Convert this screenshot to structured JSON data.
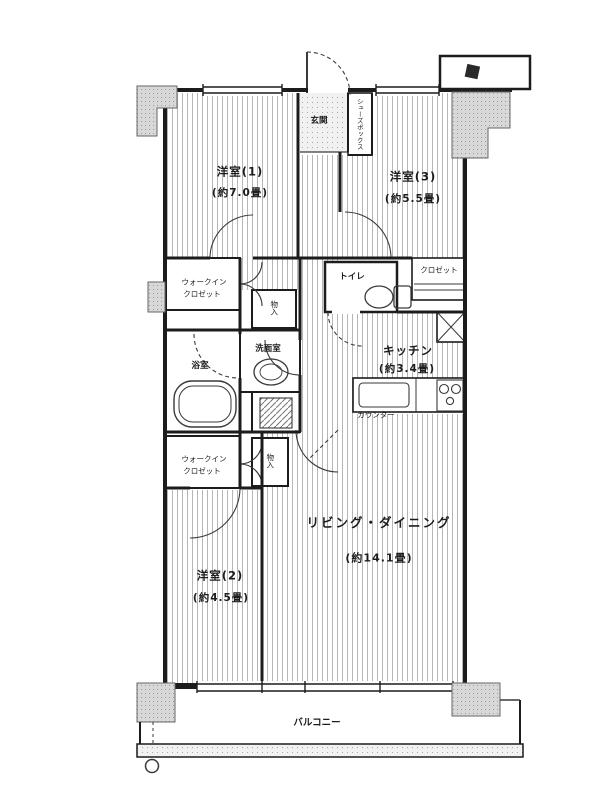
{
  "colors": {
    "ink": "#1c1c1c",
    "stripe": "#b6b6b6",
    "pillar": "#d8d8d8",
    "pillar_dot": "#9a9a9a",
    "paper": "#ffffff"
  },
  "labels": {
    "bedroom1": {
      "name": "洋室(1)",
      "size": "(約7.0畳)"
    },
    "bedroom3": {
      "name": "洋室(3)",
      "size": "(約5.5畳)"
    },
    "bedroom2": {
      "name": "洋室(2)",
      "size": "(約4.5畳)"
    },
    "living": {
      "name": "リビング・ダイニング",
      "size": "(約14.1畳)"
    },
    "kitchen": {
      "name": "キッチン",
      "size": "(約3.4畳)"
    },
    "entrance": {
      "name": "玄関"
    },
    "shoe_box": {
      "name": "シューズボックス"
    },
    "wic_upper": {
      "line1": "ウォークイン",
      "line2": "クロゼット"
    },
    "wic_lower": {
      "line1": "ウォークイン",
      "line2": "クロゼット"
    },
    "closet": {
      "name": "クロゼット"
    },
    "storage_hall": {
      "name": "物入"
    },
    "storage_lower": {
      "name": "物入"
    },
    "toilet": {
      "name": "トイレ"
    },
    "bath": {
      "name": "浴室"
    },
    "washroom": {
      "name": "洗面室"
    },
    "counter": {
      "name": "カウンター"
    },
    "balcony": {
      "name": "バルコニー"
    }
  }
}
